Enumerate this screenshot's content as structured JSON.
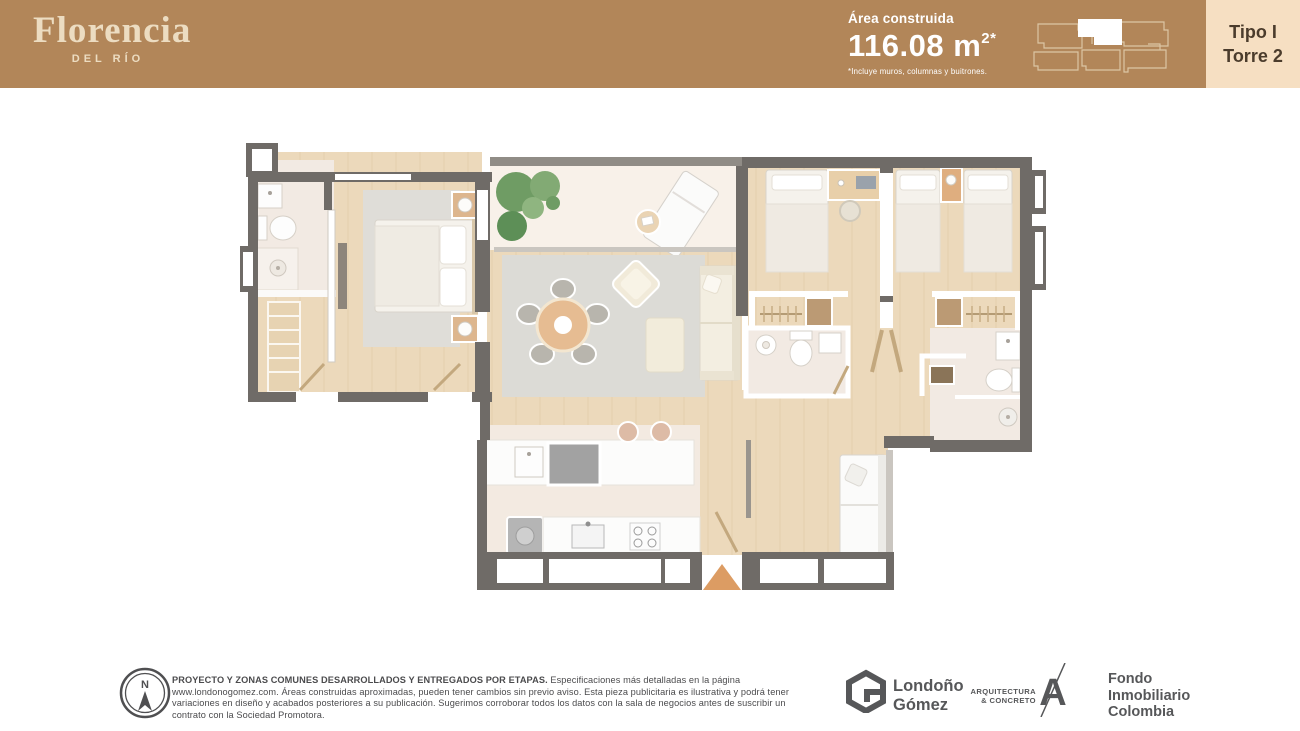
{
  "header": {
    "brand": {
      "name": "Florencia",
      "tagline": "DEL RÍO"
    },
    "area": {
      "label": "Área construida",
      "value": "116.08 m",
      "superscript": "2*",
      "note": "*Incluye muros, columnas y buitrones."
    },
    "unit_badge": {
      "line1": "Tipo I",
      "line2": "Torre 2"
    }
  },
  "footer": {
    "compass_letter": "N",
    "disclaimer_bold": "PROYECTO Y ZONAS COMUNES DESARROLLADOS Y ENTREGADOS POR ETAPAS.",
    "disclaimer_text": " Especificaciones más detalladas en la página www.londonogomez.com. Áreas construidas aproximadas, pueden tener cambios sin previo aviso. Esta pieza publicitaria es ilustrativa y podrá tener variaciones en diseño y acabados posteriores a su publicación. Sugerimos corroborar todos los datos con la sala de negocios antes de suscribir un contrato con la Sociedad Promotora.",
    "logos": {
      "londono_gomez": {
        "line1": "Londoño",
        "line2": "Gómez"
      },
      "arquitectura_concreto": {
        "line1": "ARQUITECTURA",
        "line2": "& CONCRETO",
        "monogram": "A"
      },
      "fondo_inmobiliario": {
        "line1": "Fondo",
        "line2": "Inmobiliario",
        "line3": "Colombia"
      }
    }
  },
  "colors": {
    "header_tan": "#b28659",
    "brand_cream": "#ecdcc1",
    "badge_bg": "#f6dfc2",
    "badge_text": "#4b3c2c",
    "wall_gray": "#6f6b67",
    "wood_floor": "#ecd9bb",
    "bath_tile": "#f2eae3",
    "entrance_arrow": "#dc9c63",
    "logo_gray": "#565759"
  }
}
